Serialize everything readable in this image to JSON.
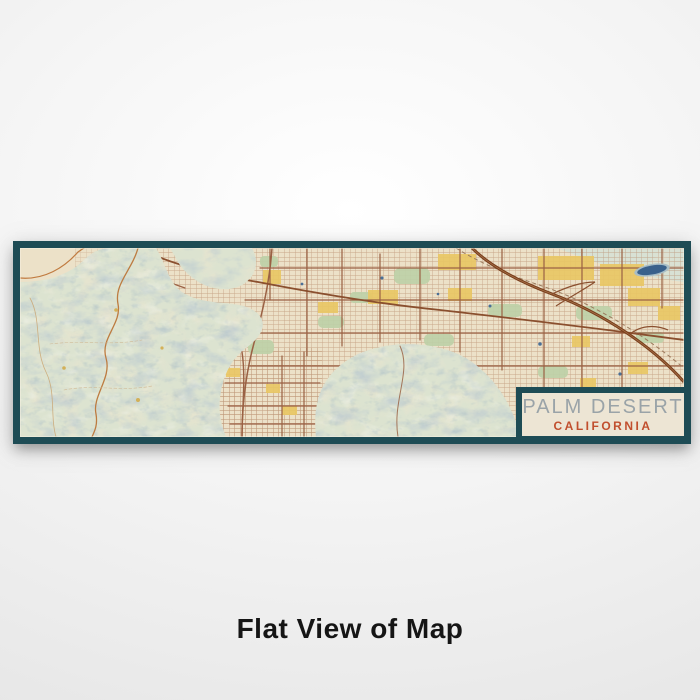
{
  "caption": "Flat View of Map",
  "map_card": {
    "title": "PALM DESERT",
    "subtitle": "CALIFORNIA",
    "attribution": "Map Data ©OSM"
  },
  "colors": {
    "frame": "#1e4c55",
    "label_background": "#ede5d4",
    "title_text": "#9aa3a8",
    "subtitle_text": "#c14f2e",
    "terrain": "#dce3d0",
    "hillshade": "#8a9aa3",
    "urban_background": "#ece1c8",
    "streets": "#9a6144",
    "highway": "#7a3f1d",
    "commercial": "#e9c765",
    "parks": "#bed1a8",
    "water": "#3a618b"
  }
}
